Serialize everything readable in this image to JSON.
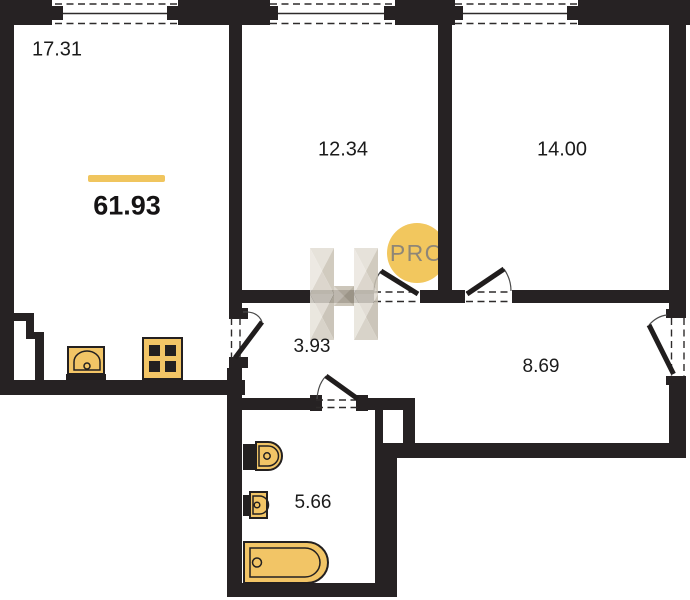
{
  "plan": {
    "total_area": {
      "value": "61.93"
    },
    "rooms": [
      {
        "name": "room-1",
        "area": "17.31"
      },
      {
        "name": "room-2",
        "area": "12.34"
      },
      {
        "name": "room-3",
        "area": "14.00"
      },
      {
        "name": "hallway",
        "area": "3.93"
      },
      {
        "name": "corridor",
        "area": "8.69"
      },
      {
        "name": "bathroom",
        "area": "5.66"
      }
    ],
    "watermark": {
      "badge": "PRO"
    },
    "colors": {
      "wall": "#262223",
      "accent": "#F0C55E",
      "fixture": "#F2C566",
      "badge_bg": "#F2C75E",
      "badge_text": "#8E8677"
    }
  }
}
